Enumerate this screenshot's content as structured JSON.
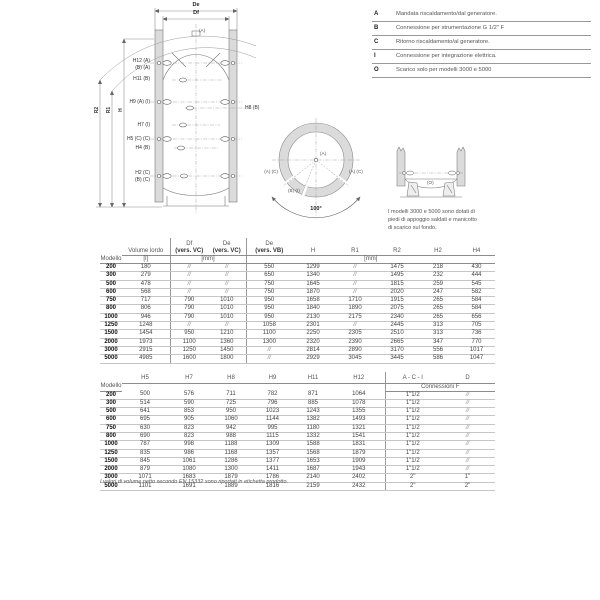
{
  "colors": {
    "wall_fill": "#dbdbdb",
    "rule": "#999999",
    "text": "#444444"
  },
  "legend": {
    "items": [
      {
        "k": "A",
        "t": "Mandata riscaldamento/dal generatore."
      },
      {
        "k": "B",
        "t": "Connessione per strumentazione G 1/2\" F"
      },
      {
        "k": "C",
        "t": "Ritorno riscaldamento/al generatore."
      },
      {
        "k": "I",
        "t": "Connessione per integrazione elettrica."
      },
      {
        "k": "O",
        "t": "Scarico solo per modelli 3000 e 5000"
      }
    ]
  },
  "front": {
    "de": "De",
    "df": "Df",
    "a_top": "(A)",
    "h12a": "H12 (A)",
    "h12b": "(B) (A)",
    "h11": "H11 (B)",
    "h9": "H9 (A) (I)",
    "h8": "H8 (B)",
    "h7": "H7 (I)",
    "h5": "H5 (C) (C)",
    "h4": "H4 (B)",
    "h2a": "H2 (C)",
    "h2b": "(B) (C)",
    "r2": "R2",
    "r1": "R1",
    "h": "H"
  },
  "top": {
    "a": "(A)",
    "left": "(A) (C)",
    "bottom": "(B) (I)",
    "right": "(A) (C)",
    "angle": "100°"
  },
  "feet": {
    "o": "(O)",
    "note1": "I modelli 3000 e 5000  sono dotati di",
    "note2": "piedi di appoggio saldati e manicotto",
    "note3": "di scarico sul fondo."
  },
  "table1": {
    "col_modello": "Modello",
    "col_volume": "Volume lordo",
    "unit_l": "[l]",
    "col_df": "Df",
    "col_df2": "(vers. VC)",
    "col_de": "De",
    "col_de2": "(vers. VC)",
    "col_devb": "De",
    "col_devb2": "(vers. VB)",
    "col_h": "H",
    "col_r1": "R1",
    "col_r2": "R2",
    "col_h2": "H2",
    "col_h4": "H4",
    "unit_mm1": "[mm]",
    "unit_mm2": "[mm]",
    "rows": [
      [
        "200",
        "180",
        "//",
        "//",
        "550",
        "1299",
        "//",
        "1475",
        "218",
        "430"
      ],
      [
        "300",
        "279",
        "//",
        "//",
        "650",
        "1340",
        "//",
        "1495",
        "232",
        "444"
      ],
      [
        "500",
        "478",
        "//",
        "//",
        "750",
        "1645",
        "//",
        "1815",
        "259",
        "545"
      ],
      [
        "600",
        "568",
        "//",
        "//",
        "750",
        "1870",
        "//",
        "2020",
        "247",
        "582"
      ],
      [
        "750",
        "717",
        "790",
        "1010",
        "950",
        "1658",
        "1710",
        "1915",
        "265",
        "584"
      ],
      [
        "800",
        "806",
        "790",
        "1010",
        "950",
        "1840",
        "1890",
        "2075",
        "265",
        "584"
      ],
      [
        "1000",
        "946",
        "790",
        "1010",
        "950",
        "2130",
        "2175",
        "2340",
        "265",
        "656"
      ],
      [
        "1250",
        "1248",
        "//",
        "//",
        "1058",
        "2301",
        "//",
        "2445",
        "313",
        "705"
      ],
      [
        "1500",
        "1454",
        "950",
        "1210",
        "1100",
        "2250",
        "2305",
        "2510",
        "313",
        "736"
      ],
      [
        "2000",
        "1973",
        "1100",
        "1360",
        "1300",
        "2320",
        "2390",
        "2665",
        "347",
        "770"
      ],
      [
        "3000",
        "2915",
        "1250",
        "1450",
        "//",
        "2814",
        "2890",
        "3170",
        "556",
        "1017"
      ],
      [
        "5000",
        "4985",
        "1600",
        "1800",
        "//",
        "2929",
        "3045",
        "3445",
        "586",
        "1047"
      ]
    ]
  },
  "table2": {
    "col_modello": "Modello",
    "cols": [
      "H5",
      "H7",
      "H8",
      "H9",
      "H11",
      "H12",
      "A - C - I",
      "D"
    ],
    "subheader": "Connessioni F",
    "rows": [
      [
        "200",
        "500",
        "576",
        "711",
        "782",
        "871",
        "1064",
        "1\"1/2",
        "//"
      ],
      [
        "300",
        "514",
        "590",
        "725",
        "796",
        "885",
        "1078",
        "1\"1/2",
        "//"
      ],
      [
        "500",
        "641",
        "853",
        "950",
        "1023",
        "1243",
        "1355",
        "1\"1/2",
        "//"
      ],
      [
        "600",
        "695",
        "905",
        "1060",
        "1144",
        "1382",
        "1493",
        "1\"1/2",
        "//"
      ],
      [
        "750",
        "630",
        "823",
        "942",
        "995",
        "1180",
        "1321",
        "1\"1/2",
        "//"
      ],
      [
        "800",
        "690",
        "823",
        "988",
        "1115",
        "1332",
        "1541",
        "1\"1/2",
        "//"
      ],
      [
        "1000",
        "787",
        "998",
        "1188",
        "1309",
        "1588",
        "1831",
        "1\"1/2",
        "//"
      ],
      [
        "1250",
        "835",
        "986",
        "1168",
        "1357",
        "1568",
        "1879",
        "1\"1/2",
        "//"
      ],
      [
        "1500",
        "845",
        "1061",
        "1286",
        "1377",
        "1653",
        "1909",
        "1\"1/2",
        "//"
      ],
      [
        "2000",
        "879",
        "1080",
        "1300",
        "1411",
        "1687",
        "1943",
        "1\"1/2",
        "//"
      ],
      [
        "3000",
        "1071",
        "1683",
        "1879",
        "1786",
        "2140",
        "2402",
        "2\"",
        "1\""
      ],
      [
        "5000",
        "1101",
        "1691",
        "1889",
        "1816",
        "2159",
        "2432",
        "2\"",
        "2\""
      ]
    ],
    "footnote": "I valori di volume netto secondo EN 15332 sono riportati in etichetta prodotto."
  }
}
